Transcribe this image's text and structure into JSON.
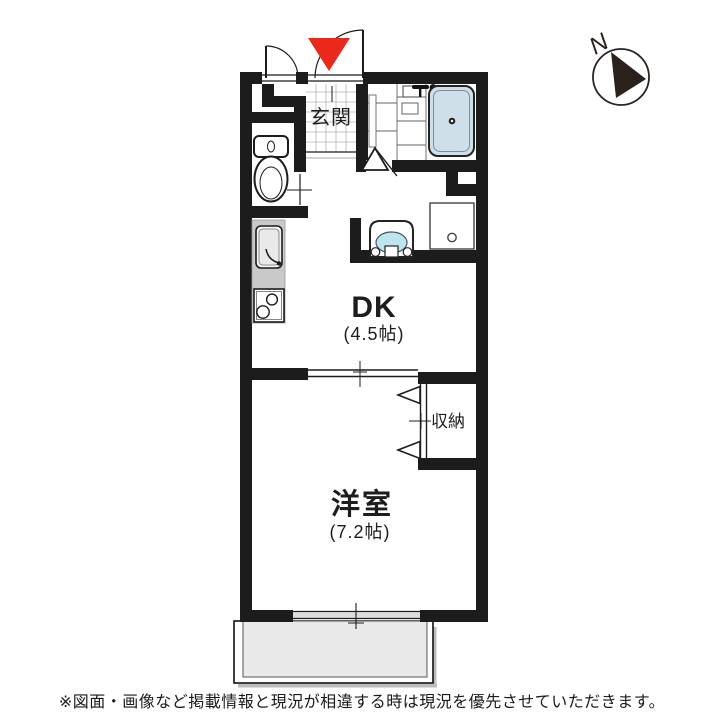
{
  "compass": {
    "label": "N"
  },
  "rooms": {
    "entrance": {
      "label": "玄関"
    },
    "dining_kitchen": {
      "label": "DK",
      "size": "(4.5帖)"
    },
    "western_room": {
      "label": "洋室",
      "size": "(7.2帖)"
    },
    "closet": {
      "label": "収納"
    }
  },
  "footer": {
    "disclaimer": "※図面・画像など掲載情報と現況が相違する時は現況を優先させていただきます。"
  },
  "colors": {
    "wall": "#1c1c1c",
    "bathtub": "#cfdfe9",
    "basin": "#bfe4ee",
    "counter": "#c9c9c9",
    "balcony": "#e9e9e9",
    "entrance_marker": "#e8291c"
  }
}
